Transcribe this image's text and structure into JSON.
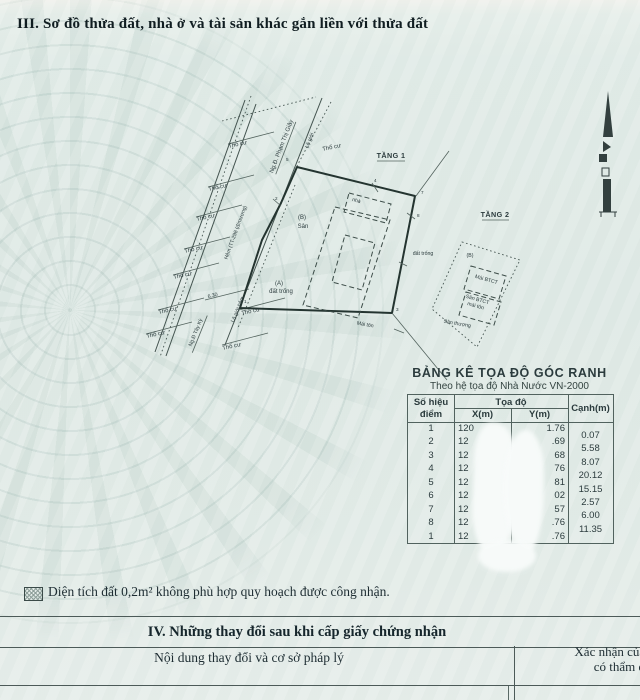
{
  "document": {
    "section3_title": "III. Sơ đồ thửa đất, nhà ở và tài sản khác gắn liền với thửa đất",
    "note": "Diện tích đất 0,2m² không phù hợp quy hoạch được công nhận.",
    "section4_title": "IV. Những thay đổi sau khi cấp giấy chứng nhận",
    "change_table": {
      "content_col": "Nội dung thay đổi và cơ sở pháp lý",
      "confirm_col_line1": "Xác nhận của cơ quan",
      "confirm_col_line2": "có thẩm quyền"
    }
  },
  "diagram": {
    "floor1_label": "TẦNG 1",
    "floor2_label": "TẦNG 2",
    "adjacent_label": "Thổ cư",
    "alley_label": "Hẻm (TT-298 (đ/mương)",
    "street_label": "Ng.Đ. Phạm Thị Giây",
    "street2_label": "Ng.Đ Tây Kỳ",
    "road_boundary_label": "Lộ giới",
    "alley_boundary_label": "Lộ giới hẻm",
    "width_dim": "6.30",
    "zone_a": "(A)",
    "zone_a_name": "đất trống",
    "zone_b": "(B)",
    "zone_b_name": "Sân",
    "house_label": "nhà",
    "metal_roof_label": "Mái tôn",
    "empty_land_label": "đất trống",
    "zone_b2": "(B)",
    "concrete_roof_label": "Mái BTCT",
    "concrete_yard_line1": "Sân BTCT",
    "concrete_yard_line2": "mái tôn",
    "terrace_label": "Sân thượng",
    "corner_1": "1",
    "corner_2": "2",
    "corner_3": "3",
    "corner_4": "4",
    "corner_5": "5",
    "corner_7": "7",
    "corner_8": "8"
  },
  "coord_table": {
    "title": "BẢNG KÊ TỌA ĐỘ GÓC RANH",
    "subtitle": "Theo hệ tọa độ Nhà Nước VN-2000",
    "header": {
      "point_line1": "Số hiệu",
      "point_line2": "điểm",
      "coords": "Tọa độ",
      "x": "X(m)",
      "y": "Y(m)",
      "edge": "Cạnh(m)"
    },
    "rows": [
      {
        "point": "1",
        "x": "120",
        "y": "1.76"
      },
      {
        "point": "2",
        "x": "12",
        "y": ".69"
      },
      {
        "point": "3",
        "x": "12",
        "y": "68"
      },
      {
        "point": "4",
        "x": "12",
        "y": "76"
      },
      {
        "point": "5",
        "x": "12",
        "y": "81"
      },
      {
        "point": "6",
        "x": "12",
        "y": "02"
      },
      {
        "point": "7",
        "x": "12",
        "y": "57"
      },
      {
        "point": "8",
        "x": "12",
        "y": ".76"
      },
      {
        "point": "1",
        "x": "12",
        "y": ".76"
      }
    ],
    "edges": [
      "0.07",
      "5.58",
      "8.07",
      "20.12",
      "15.15",
      "2.57",
      "6.00",
      "11.35"
    ]
  }
}
